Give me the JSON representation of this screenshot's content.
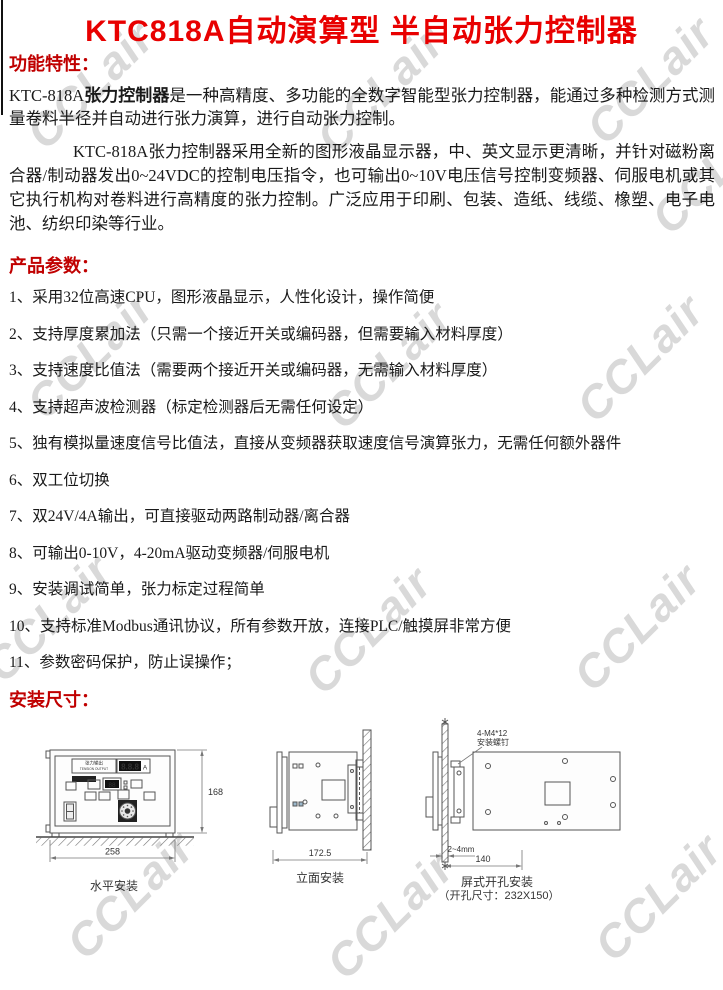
{
  "theme": {
    "title_color": "#e80000",
    "heading_color": "#c00000",
    "text_color": "#1a1a1a",
    "watermark_color": "#d9d9d9",
    "diagram_line_color": "#555555"
  },
  "watermark": {
    "text": "CCLair"
  },
  "page": {
    "title": "KTC818A自动演算型 半自动张力控制器"
  },
  "sections": {
    "features_heading": "功能特性：",
    "params_heading": "产品参数：",
    "install_heading": "安装尺寸："
  },
  "intro": {
    "p1_model": "KTC-818A",
    "p1_bold": "张力控制器",
    "p1_rest": "是一种高精度、多功能的全数字智能型张力控制器，能通过多种检测方式测量卷料半径并自动进行张力演算，进行自动张力控制。",
    "p2": "KTC-818A张力控制器采用全新的图形液晶显示器，中、英文显示更清晰，并针对磁粉离合器/制动器发出0~24VDC的控制电压指令，也可输出0~10V电压信号控制变频器、伺服电机或其它执行机构对卷料进行高精度的张力控制。广泛应用于印刷、包装、造纸、线缆、橡塑、电子电池、纺织印染等行业。"
  },
  "product_params": {
    "items": [
      "1、采用32位高速CPU，图形液晶显示，人性化设计，操作简便",
      "2、支持厚度累加法（只需一个接近开关或编码器，但需要输入材料厚度）",
      "3、支持速度比值法（需要两个接近开关或编码器，无需输入材料厚度）",
      "4、支持超声波检测器（标定检测器后无需任何设定）",
      "5、独有模拟量速度信号比值法，直接从变频器获取速度信号演算张力，无需任何额外器件",
      "6、双工位切换",
      "7、双24V/4A输出，可直接驱动两路制动器/离合器",
      "8、可输出0-10V，4-20mA驱动变频器/伺服电机",
      "9、安装调试简单，张力标定过程简单",
      "10、支持标准Modbus通讯协议，所有参数开放，连接PLC/触摸屏非常方便",
      "11、参数密码保护，防止误操作；"
    ]
  },
  "diagrams": {
    "horizontal": {
      "caption": "水平安装",
      "height_dim": "168",
      "width_dim": "258",
      "display_label_cn": "张力输出",
      "display_label_en": "TENSION OUTPUT",
      "display_value": "8.8.8",
      "display_unit": "A",
      "sub_display_value": "88"
    },
    "side": {
      "caption": "立面安装",
      "depth_dim": "172.5"
    },
    "panel": {
      "caption": "屏式开孔安装",
      "cutout_note": "（开孔尺寸：232X150）",
      "screw_label1": "4-M4*12",
      "screw_label2": "安装螺钉",
      "gap_dim": "2~4mm",
      "width_dim": "140"
    }
  }
}
